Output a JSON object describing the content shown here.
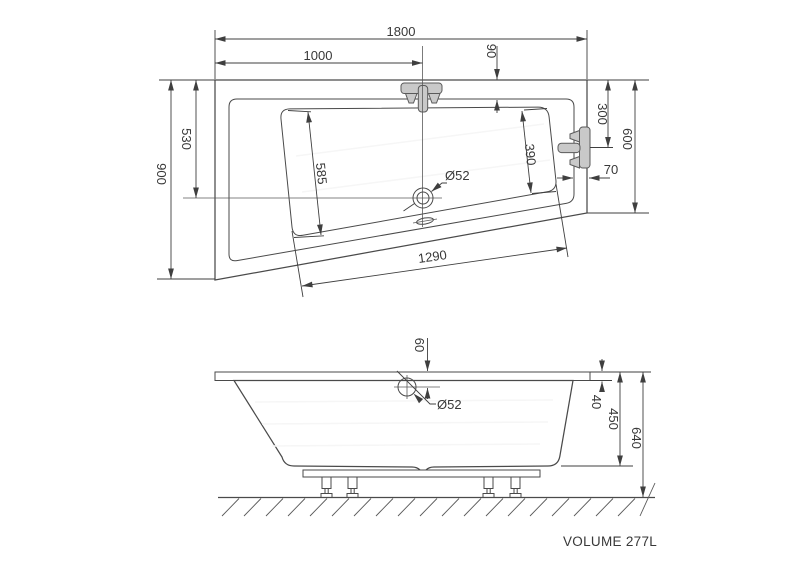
{
  "colors": {
    "line": "#4a4a4a",
    "dim_line": "#3f3f3f",
    "tub_fill": "#e7e7e7",
    "basin_fill": "#ededed",
    "flange_fill": "#dcdcdc",
    "body_fill": "#ececec",
    "fixture_fill": "#c9c9c9",
    "text": "#383838"
  },
  "plan": {
    "overall_length": "1800",
    "faucet_offset": "1000",
    "top_rim_width": "90",
    "overall_width": "900",
    "drain_offset_top": "530",
    "basin_left_length": "585",
    "basin_right_length": "390",
    "basin_bottom_length": "1290",
    "right_side_width": "600",
    "fixture_offset": "300",
    "right_rim_width": "70",
    "drain_diameter": "Ø52"
  },
  "side": {
    "overflow_offset": "60",
    "overflow_diameter": "Ø52",
    "rim_thickness": "40",
    "tub_depth": "450",
    "total_height": "640"
  },
  "footer": {
    "volume_label": "VOLUME 277L"
  }
}
